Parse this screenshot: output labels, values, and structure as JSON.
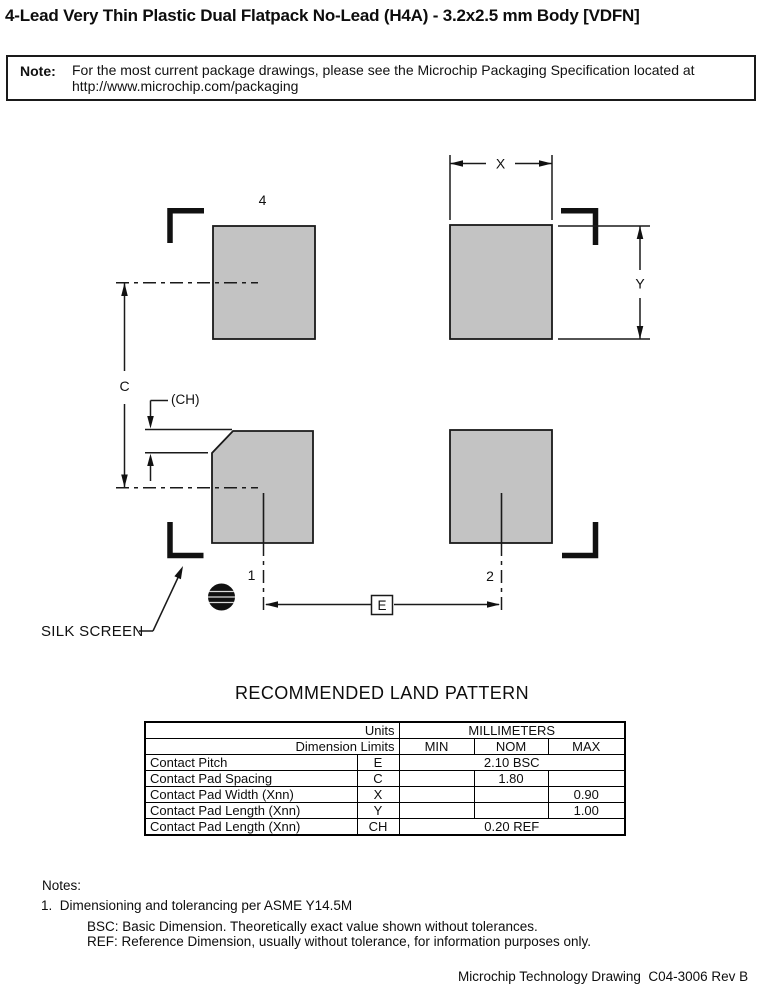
{
  "title": "4-Lead Very Thin Plastic Dual Flatpack No-Lead (H4A) - 3.2x2.5 mm Body [VDFN]",
  "note": {
    "label": "Note:",
    "line1": "For the most current package drawings, please see the Microchip Packaging Specification located at",
    "line2": "http://www.microchip.com/packaging"
  },
  "drawing": {
    "pad_color": "#c3c3c3",
    "line_color": "#1a1a1a",
    "labels": {
      "pad4": "4",
      "pad1": "1",
      "pad2": "2",
      "dim_x": "X",
      "dim_y": "Y",
      "dim_c": "C",
      "dim_ch": "(CH)",
      "dim_e": "E",
      "silk_screen": "SILK SCREEN"
    }
  },
  "land_pattern_heading": "RECOMMENDED LAND PATTERN",
  "table": {
    "header": {
      "units_label": "Units",
      "millimeters_label": "MILLIMETERS",
      "dimension_limits_label": "Dimension Limits",
      "min": "MIN",
      "nom": "NOM",
      "max": "MAX"
    },
    "rows": [
      {
        "name": "Contact Pitch",
        "symbol": "E",
        "span_value": "2.10 BSC"
      },
      {
        "name": "Contact Pad Spacing",
        "symbol": "C",
        "min": "",
        "nom": "1.80",
        "max": ""
      },
      {
        "name": "Contact Pad Width (Xnn)",
        "symbol": "X",
        "min": "",
        "nom": "",
        "max": "0.90"
      },
      {
        "name": "Contact Pad Length (Xnn)",
        "symbol": "Y",
        "min": "",
        "nom": "",
        "max": "1.00"
      },
      {
        "name": "Contact Pad Length (Xnn)",
        "symbol": "CH",
        "span_value": "0.20 REF"
      }
    ]
  },
  "notes": {
    "heading": "Notes:",
    "item1": "1.  Dimensioning and tolerancing per ASME Y14.5M",
    "sub1": "BSC: Basic Dimension. Theoretically exact value shown without tolerances.",
    "sub2": "REF: Reference Dimension, usually without tolerance, for information purposes only."
  },
  "footer": "Microchip Technology Drawing  C04-3006 Rev B"
}
